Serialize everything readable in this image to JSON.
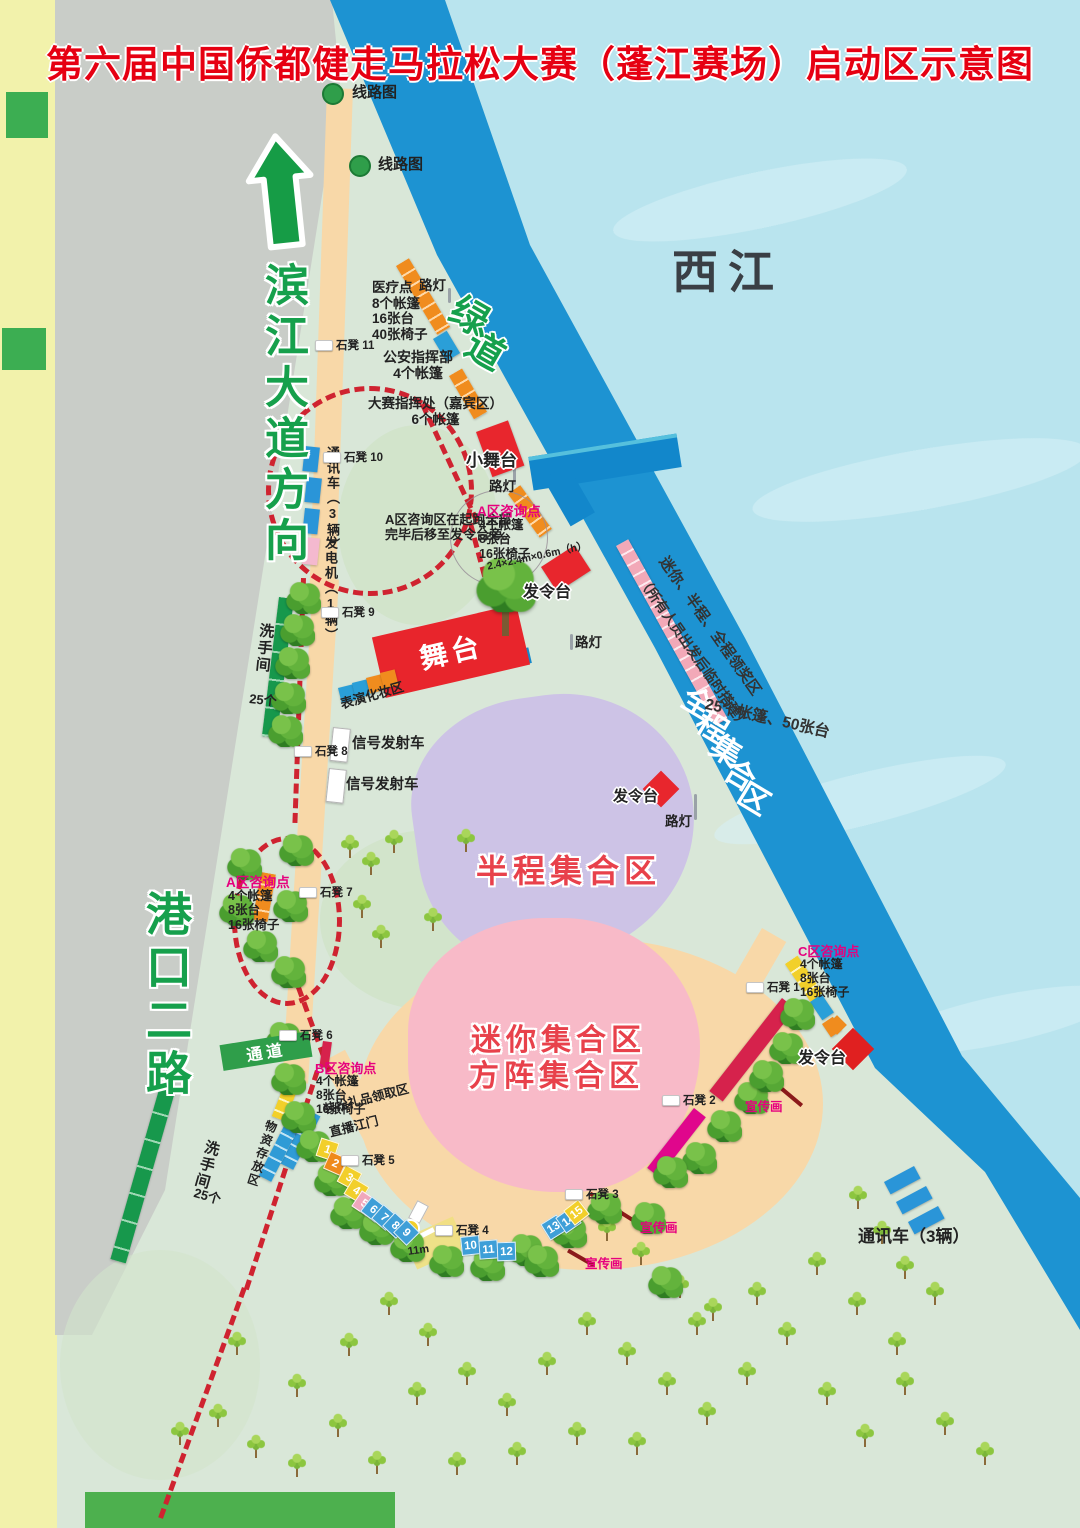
{
  "title": "第六届中国侨都健走马拉松大赛（蓬江赛场）启动区示意图",
  "river_label": "西江",
  "greenway_label": "绿道",
  "road_labels": {
    "binjiang": "滨江大道方向",
    "gangkou": "港口二路"
  },
  "zones": {
    "full": "全程集合区",
    "half": "半程集合区",
    "mini": "迷你集合区",
    "formation": "方阵集合区"
  },
  "award_area": {
    "line1": "迷你、半程、全程领奖区",
    "line2": "（所有人员出发后临时搭建）",
    "equipment": "25个帐篷、50张台"
  },
  "stage_label": "舞台",
  "passage_label": "通道",
  "annotations": [
    {
      "id": "route-map-1",
      "lines": [
        "线路图"
      ]
    },
    {
      "id": "route-map-2",
      "lines": [
        "线路图"
      ]
    },
    {
      "id": "lamp-1",
      "lines": [
        "路灯"
      ]
    },
    {
      "id": "medical",
      "lines": [
        "医疗点",
        "8个帐篷",
        "16张台",
        "40张椅子"
      ]
    },
    {
      "id": "police",
      "lines": [
        "公安指挥部",
        "4个帐篷"
      ]
    },
    {
      "id": "command",
      "lines": [
        "大赛指挥处（嘉宾区）",
        "6个帐篷"
      ]
    },
    {
      "id": "small-stage",
      "lines": [
        "小舞台"
      ]
    },
    {
      "id": "lamp-2",
      "lines": [
        "路灯"
      ]
    },
    {
      "id": "comms-top",
      "lines": [
        "通讯车（3辆）"
      ]
    },
    {
      "id": "generator",
      "lines": [
        "发电机（1辆）"
      ]
    },
    {
      "id": "a-note",
      "lines": [
        "A区咨询区在起跑全部",
        "完毕后移至发令台旁。"
      ]
    },
    {
      "id": "a-point-top",
      "lines": [
        "A区咨询点"
      ]
    },
    {
      "id": "a-point-top-info",
      "lines": [
        "4个帐篷",
        "8张台",
        "16张椅子"
      ]
    },
    {
      "id": "tree-dim",
      "lines": [
        "2.4×2.4m×0.6m（h）"
      ]
    },
    {
      "id": "start-platform-1",
      "lines": [
        "发令台"
      ]
    },
    {
      "id": "makeup",
      "lines": [
        "表演化妆区"
      ]
    },
    {
      "id": "toilets-top",
      "lines": [
        "洗手间"
      ]
    },
    {
      "id": "toilets-top-count",
      "lines": [
        "25个"
      ]
    },
    {
      "id": "signal-1",
      "lines": [
        "信号发射车"
      ]
    },
    {
      "id": "signal-2",
      "lines": [
        "信号发射车"
      ]
    },
    {
      "id": "lamp-3",
      "lines": [
        "路灯"
      ]
    },
    {
      "id": "start-platform-2",
      "lines": [
        "发令台"
      ]
    },
    {
      "id": "lamp-4",
      "lines": [
        "路灯"
      ]
    },
    {
      "id": "a-point-2",
      "lines": [
        "A区咨询点"
      ]
    },
    {
      "id": "a-point-2-info",
      "lines": [
        "4个帐篷",
        "8张台",
        "16张椅子"
      ]
    },
    {
      "id": "b-point",
      "lines": [
        "B区咨询点"
      ]
    },
    {
      "id": "b-point-info",
      "lines": [
        "4个帐篷",
        "8张台",
        "16张椅子"
      ]
    },
    {
      "id": "costume",
      "lines": [
        "装扮礼品领取区"
      ]
    },
    {
      "id": "live",
      "lines": [
        "直播江门"
      ]
    },
    {
      "id": "storage",
      "lines": [
        "物资存放区"
      ]
    },
    {
      "id": "toilets-bottom",
      "lines": [
        "洗手间"
      ]
    },
    {
      "id": "toilets-bottom-count",
      "lines": [
        "25个"
      ]
    },
    {
      "id": "path-width",
      "lines": [
        "11m"
      ]
    },
    {
      "id": "c-point",
      "lines": [
        "C区咨询点"
      ]
    },
    {
      "id": "c-point-info",
      "lines": [
        "4个帐篷",
        "8张台",
        "16张椅子"
      ]
    },
    {
      "id": "start-platform-3",
      "lines": [
        "发令台"
      ]
    },
    {
      "id": "banner-1",
      "lines": [
        "宣传画"
      ]
    },
    {
      "id": "banner-2",
      "lines": [
        "宣传画"
      ]
    },
    {
      "id": "banner-3",
      "lines": [
        "宣传画"
      ]
    },
    {
      "id": "comms-bottom",
      "lines": [
        "通讯车（3辆）"
      ]
    }
  ],
  "benches": [
    "石凳 11",
    "石凳 10",
    "石凳 9",
    "石凳 8",
    "石凳 7",
    "石凳 6",
    "石凳 5",
    "石凳 4",
    "石凳 3",
    "石凳 2",
    "石凳 1"
  ],
  "route_numbers": [
    {
      "n": "1",
      "color": "#f2cf2a"
    },
    {
      "n": "2",
      "color": "#ef8a1a"
    },
    {
      "n": "3",
      "color": "#f2cf2a"
    },
    {
      "n": "4",
      "color": "#f2cf2a"
    },
    {
      "n": "5",
      "color": "#f0a8bc"
    },
    {
      "n": "6",
      "color": "#3e9fd8"
    },
    {
      "n": "7",
      "color": "#3e9fd8"
    },
    {
      "n": "8",
      "color": "#3e9fd8"
    },
    {
      "n": "9",
      "color": "#3e9fd8"
    },
    {
      "n": "10",
      "color": "#3e9fd8"
    },
    {
      "n": "11",
      "color": "#3e9fd8"
    },
    {
      "n": "12",
      "color": "#3e9fd8"
    },
    {
      "n": "13",
      "color": "#3e9fd8"
    },
    {
      "n": "14",
      "color": "#3e9fd8"
    },
    {
      "n": "15",
      "color": "#f2cf2a"
    }
  ],
  "colors": {
    "title_red": "#e60012",
    "greenway_band": "#1d93d2",
    "water": "#b9e4ee",
    "venue": "#d9e7d8",
    "route_dash_red": "#cf2330",
    "half_zone_purple": "#cdc3e6",
    "mini_zone_pink": "#f8bac8",
    "start_path_peach": "#f8d8a8",
    "road_green_text": "#16a04c",
    "consult_magenta": "#e6007e"
  }
}
